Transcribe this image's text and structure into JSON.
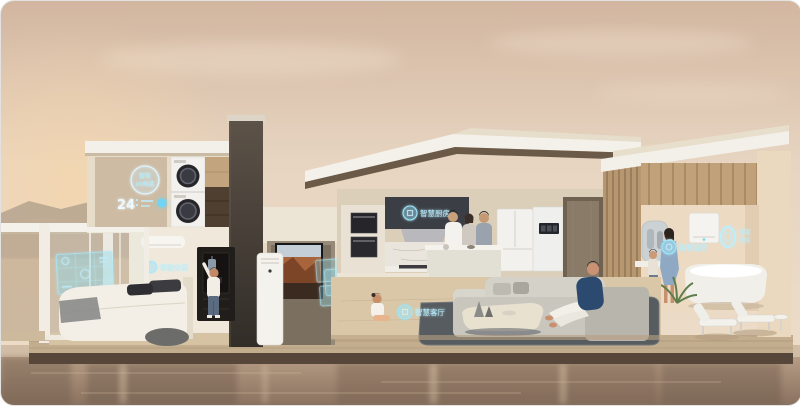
{
  "scene": {
    "description": "Smart home concept render: cutaway modern villa at dusk with smart appliances, holographic labels and residents",
    "badges": {
      "laundry": {
        "line1": "智能",
        "line2": "UV除菌"
      },
      "laundry_clock": "24",
      "bedroom_ac": "智能空调",
      "kitchen": "智慧厨房",
      "living_room": "智慧客厅",
      "bathroom": "智慧浴室",
      "bath_ring": {
        "line1": "恒温",
        "line2": "洗浴"
      }
    },
    "colors": {
      "sky_top": "#d5b9a3",
      "sky_bottom": "#ecdcc8",
      "holo_glow": "#8fe4fa",
      "house_wall": "#ece3d3",
      "wood_slat": "#bf9f78",
      "deck_wood": "#c3ad8f",
      "water": "#a78d76"
    }
  }
}
